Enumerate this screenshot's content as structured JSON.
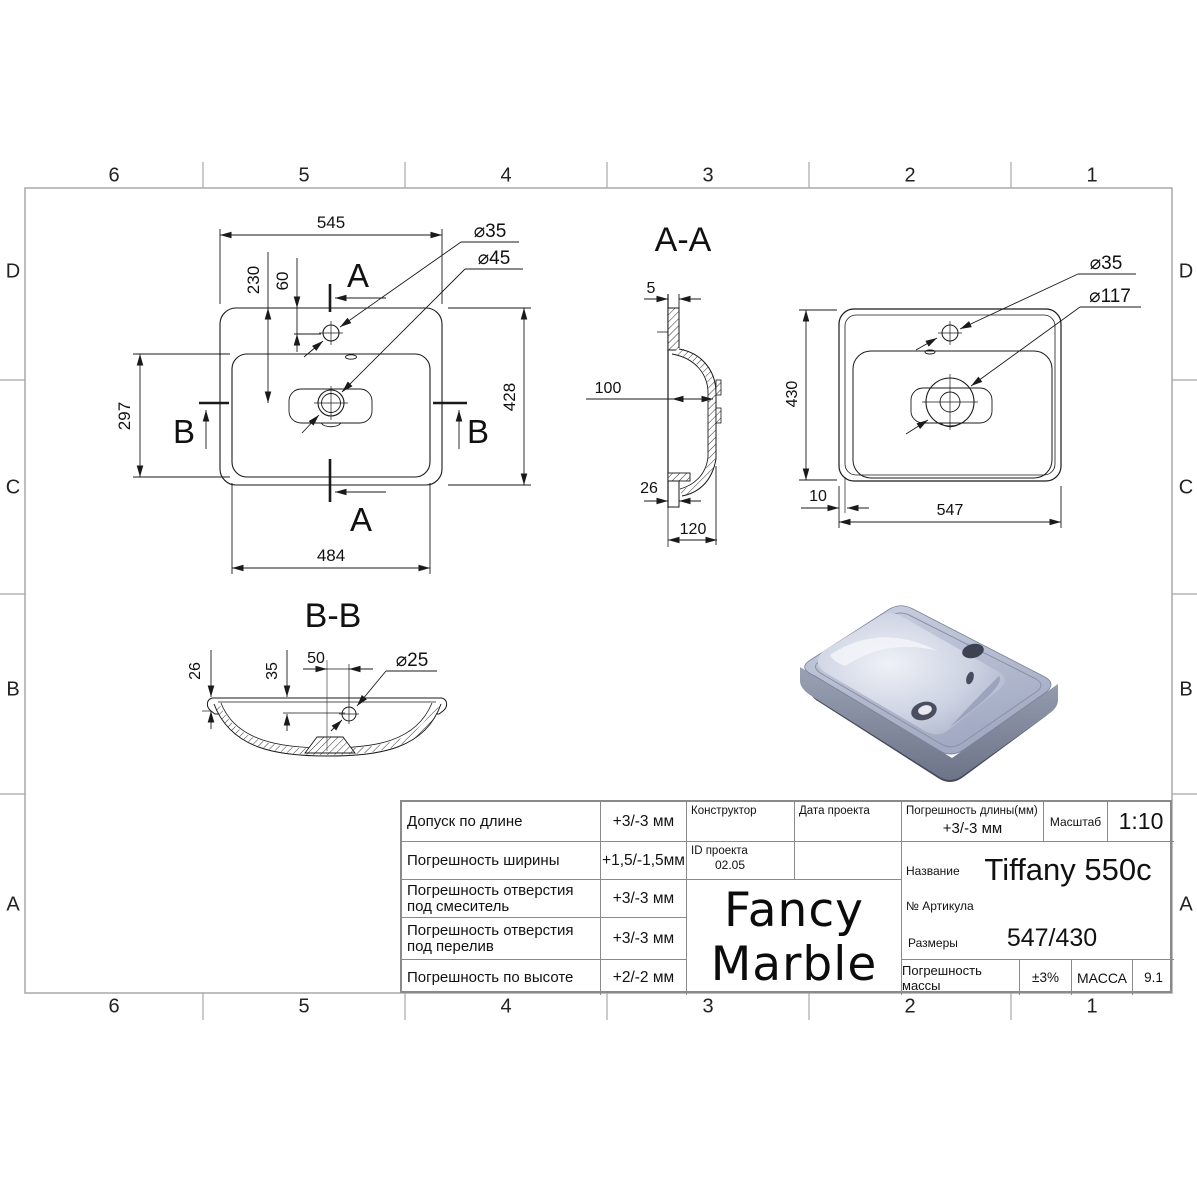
{
  "sheet": {
    "columns": [
      "6",
      "5",
      "4",
      "3",
      "2",
      "1"
    ],
    "rows": [
      "D",
      "C",
      "B",
      "A"
    ]
  },
  "dims": {
    "plan_width": "545",
    "plan_drain_offset": "230",
    "plan_faucet_offset": "60",
    "plan_bowl_height": "297",
    "plan_height": "428",
    "plan_bowl_width": "484",
    "plan_faucet_dia": "⌀35",
    "plan_drain_dia": "⌀45",
    "section_a_letter": "A",
    "section_b_letter": "B",
    "aa_title": "A-A",
    "aa_wall": "5",
    "aa_bowl_depth": "100",
    "aa_front_rim": "26",
    "aa_total_depth": "120",
    "aa_height": "430",
    "aa_rim": "10",
    "aa_width": "547",
    "aa_faucet_dia": "⌀35",
    "aa_drain_dia": "⌀117",
    "bb_title": "B-B",
    "bb_rim": "26",
    "bb_drain_depth": "35",
    "bb_drain_offset": "50",
    "bb_drain_dia": "⌀25"
  },
  "title_block": {
    "rows": [
      {
        "label": "Допуск по длине",
        "value": "+3/-3 мм"
      },
      {
        "label": "Погрешность ширины",
        "value": "+1,5/-1,5мм"
      },
      {
        "label": "Погрешность отверстия под смеситель",
        "value": "+3/-3 мм"
      },
      {
        "label": "Погрешность отверстия под перелив",
        "value": "+3/-3 мм"
      },
      {
        "label": "Погрешность по высоте",
        "value": "+2/-2 мм"
      }
    ],
    "constructor_label": "Конструктор",
    "project_id_label": "ID проекта",
    "project_id": "02.05",
    "project_date_label": "Дата проекта",
    "length_tolerance_label": "Погрешность длины(мм)",
    "length_tolerance": "+3/-3 мм",
    "scale_label": "Масштаб",
    "scale": "1:10",
    "name_label": "Название",
    "name": "Tiffany 550c",
    "article_label": "№ Артикула",
    "size_label": "Размеры",
    "size": "547/430",
    "mass_tolerance_label": "Погрешность массы",
    "mass_tolerance": "±3%",
    "mass_label": "МАССА",
    "mass": "9.1",
    "logo_line1": "Fancy",
    "logo_line2": "Marble"
  },
  "colors": {
    "line": "#1a1a1a",
    "frame": "#a8a8a8",
    "sink_top": "#b4bcd2",
    "sink_bowl_light": "#eef1f7",
    "sink_side": "#8d95aa",
    "sink_base": "#454a59"
  }
}
